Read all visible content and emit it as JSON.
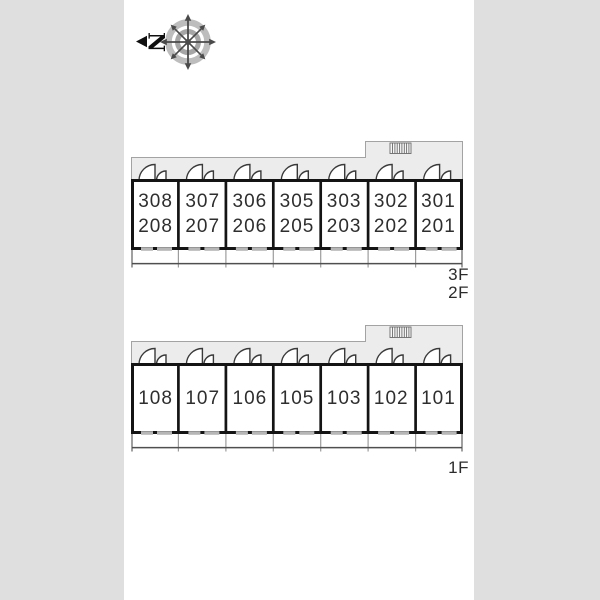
{
  "compass": {
    "north_label": "N"
  },
  "plans": [
    {
      "id": "upper-floors",
      "floor_labels": [
        "3F",
        "2F"
      ],
      "rooms": [
        {
          "line1": "308",
          "line2": "208"
        },
        {
          "line1": "307",
          "line2": "207"
        },
        {
          "line1": "306",
          "line2": "206"
        },
        {
          "line1": "305",
          "line2": "205"
        },
        {
          "line1": "303",
          "line2": "203"
        },
        {
          "line1": "302",
          "line2": "202"
        },
        {
          "line1": "301",
          "line2": "201"
        }
      ]
    },
    {
      "id": "first-floor",
      "floor_labels": [
        "1F"
      ],
      "rooms": [
        {
          "line1": "108"
        },
        {
          "line1": "107"
        },
        {
          "line1": "106"
        },
        {
          "line1": "105"
        },
        {
          "line1": "103"
        },
        {
          "line1": "102"
        },
        {
          "line1": "101"
        }
      ]
    }
  ],
  "icons": {
    "compass": "compass-rose-icon",
    "north_arrow": "north-arrow-icon",
    "door": "door-swing-icon",
    "stairs": "stairs-hatch-icon"
  },
  "colors": {
    "background": "#dfdfdf",
    "page": "#ffffff",
    "wall": "#141414",
    "corridor_fill": "#ececec",
    "corridor_outline": "#a3a3a3",
    "window": "#b6b6b6",
    "balcony_line": "#8c8c8c",
    "text": "#2e2e2e"
  }
}
